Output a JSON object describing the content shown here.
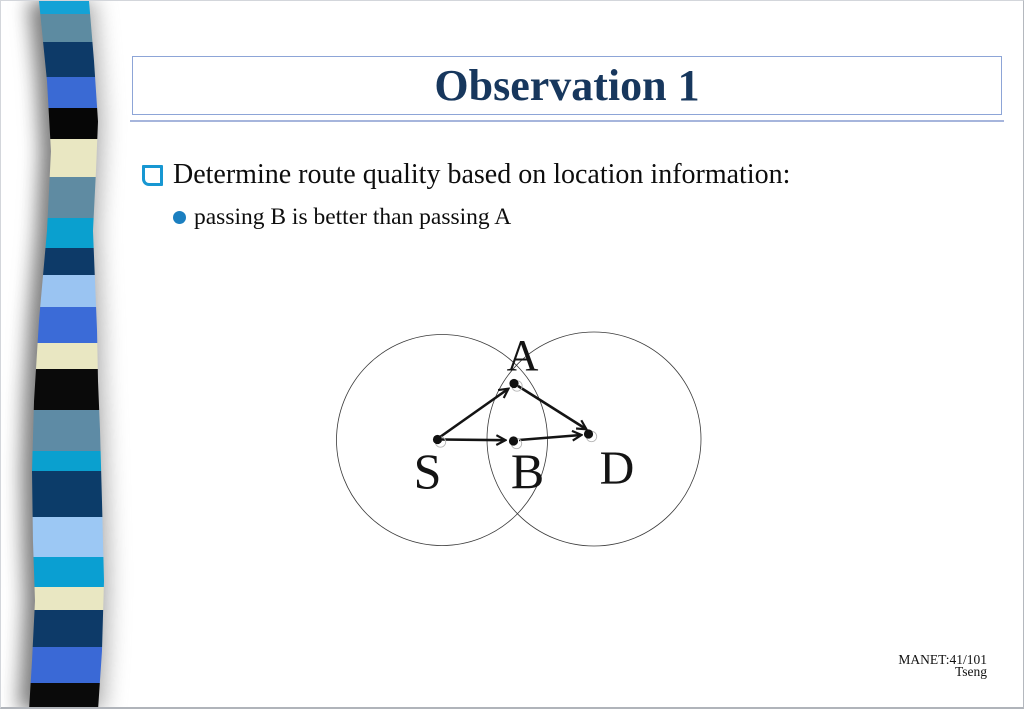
{
  "title": {
    "text": "Observation 1"
  },
  "bullets": {
    "main": "Determine route quality based on location information:",
    "sub": "passing B is better than passing A"
  },
  "footer": {
    "slide_ref": "MANET:41/101",
    "author": "Tseng"
  },
  "colors": {
    "title_text": "#17375d",
    "title_box_border": "#8da5d7",
    "title_rule": "#a6b5dc",
    "square_bullet": "#1797d2",
    "circle_bullet": "#1b7fc0",
    "diagram_ink": "#141414"
  },
  "diagram": {
    "type": "node-link",
    "range_circle_count": 2,
    "nodes": [
      {
        "id": "S",
        "label": "S"
      },
      {
        "id": "B",
        "label": "B"
      },
      {
        "id": "D",
        "label": "D"
      },
      {
        "id": "A",
        "label": "A"
      }
    ],
    "edges": [
      {
        "from": "S",
        "to": "A"
      },
      {
        "from": "A",
        "to": "D"
      },
      {
        "from": "S",
        "to": "B"
      },
      {
        "from": "B",
        "to": "D"
      }
    ]
  },
  "ribbon": {
    "stripes": [
      {
        "color": "#14a2d6",
        "from": 0,
        "to": 13
      },
      {
        "color": "#5d8ba1",
        "from": 13,
        "to": 41
      },
      {
        "color": "#0d3a68",
        "from": 41,
        "to": 76
      },
      {
        "color": "#3a6ad4",
        "from": 76,
        "to": 107
      },
      {
        "color": "#060606",
        "from": 107,
        "to": 138
      },
      {
        "color": "#e9e7c2",
        "from": 138,
        "to": 176
      },
      {
        "color": "#5f8ba2",
        "from": 176,
        "to": 217
      },
      {
        "color": "#0aa0cf",
        "from": 217,
        "to": 247
      },
      {
        "color": "#0d3a68",
        "from": 247,
        "to": 274
      },
      {
        "color": "#9ac4f2",
        "from": 274,
        "to": 306
      },
      {
        "color": "#3b6bd7",
        "from": 306,
        "to": 342
      },
      {
        "color": "#e9e7c2",
        "from": 342,
        "to": 368
      },
      {
        "color": "#0a0a0a",
        "from": 368,
        "to": 409
      },
      {
        "color": "#5e8ba5",
        "from": 409,
        "to": 450
      },
      {
        "color": "#0aa0cf",
        "from": 450,
        "to": 470
      },
      {
        "color": "#0c3c69",
        "from": 470,
        "to": 516
      },
      {
        "color": "#9cc8f4",
        "from": 516,
        "to": 556
      },
      {
        "color": "#0a9fd2",
        "from": 556,
        "to": 586
      },
      {
        "color": "#e9e7c2",
        "from": 586,
        "to": 609
      },
      {
        "color": "#0d3a68",
        "from": 609,
        "to": 646
      },
      {
        "color": "#3a69d6",
        "from": 646,
        "to": 682
      },
      {
        "color": "#0a0a0a",
        "from": 682,
        "to": 709
      }
    ]
  }
}
